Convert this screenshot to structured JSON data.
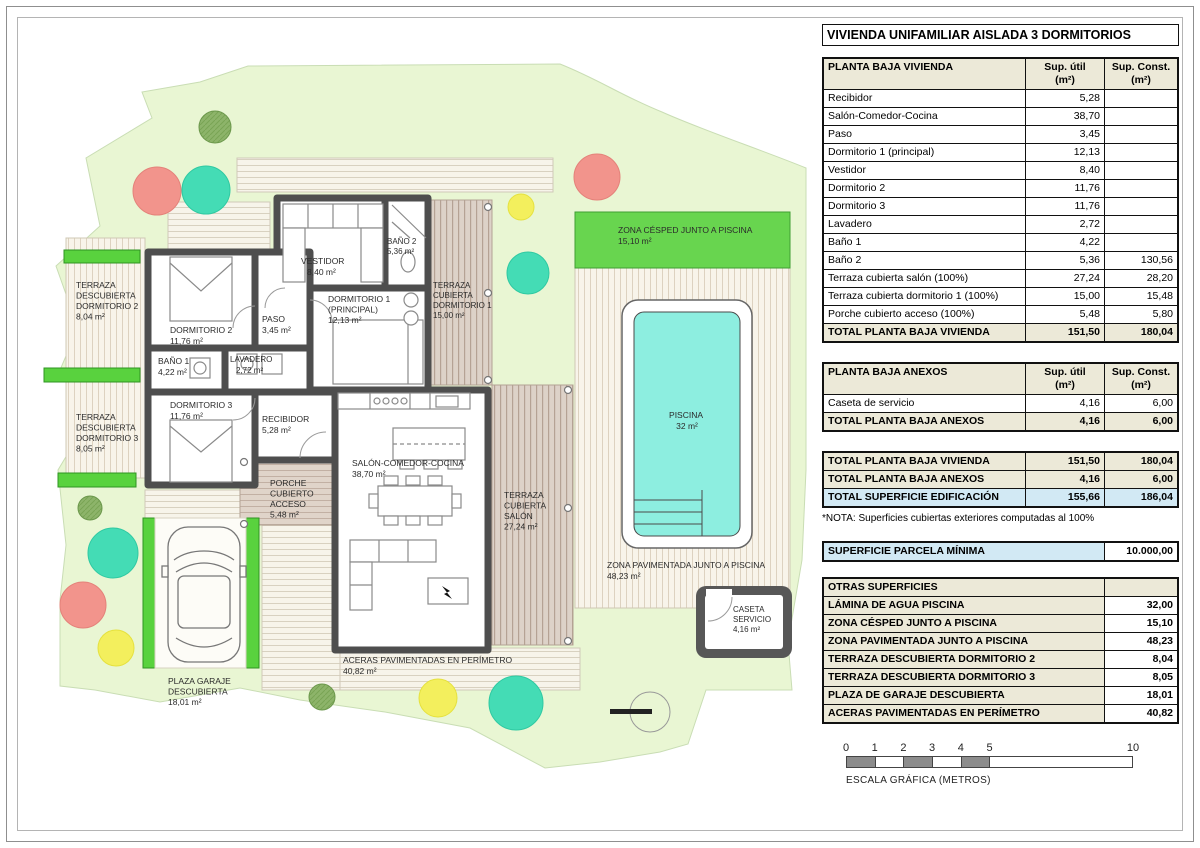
{
  "title": "VIVIENDA UNIFAMILIAR AISLADA 3 DORMITORIOS",
  "columns": {
    "util": "Sup. útil\n(m²)",
    "const": "Sup. Const.\n(m²)"
  },
  "tables": {
    "t1": {
      "header": "PLANTA BAJA VIVIENDA",
      "rows": [
        {
          "l": "Recibidor",
          "u": "5,28",
          "c": ""
        },
        {
          "l": "Salón-Comedor-Cocina",
          "u": "38,70",
          "c": ""
        },
        {
          "l": "Paso",
          "u": "3,45",
          "c": ""
        },
        {
          "l": "Dormitorio 1 (principal)",
          "u": "12,13",
          "c": ""
        },
        {
          "l": "Vestidor",
          "u": "8,40",
          "c": ""
        },
        {
          "l": "Dormitorio 2",
          "u": "11,76",
          "c": ""
        },
        {
          "l": "Dormitorio 3",
          "u": "11,76",
          "c": ""
        },
        {
          "l": "Lavadero",
          "u": "2,72",
          "c": ""
        },
        {
          "l": "Baño 1",
          "u": "4,22",
          "c": ""
        },
        {
          "l": "Baño 2",
          "u": "5,36",
          "c": "130,56"
        },
        {
          "l": "Terraza cubierta salón (100%)",
          "u": "27,24",
          "c": "28,20"
        },
        {
          "l": "Terraza cubierta dormitorio 1 (100%)",
          "u": "15,00",
          "c": "15,48"
        },
        {
          "l": "Porche cubierto acceso (100%)",
          "u": "5,48",
          "c": "5,80"
        }
      ],
      "total": {
        "l": "TOTAL PLANTA BAJA VIVIENDA",
        "u": "151,50",
        "c": "180,04"
      }
    },
    "t2": {
      "header": "PLANTA BAJA ANEXOS",
      "rows": [
        {
          "l": "Caseta de servicio",
          "u": "4,16",
          "c": "6,00"
        }
      ],
      "total": {
        "l": "TOTAL PLANTA BAJA ANEXOS",
        "u": "4,16",
        "c": "6,00"
      }
    },
    "t3": {
      "rows": [
        {
          "l": "TOTAL PLANTA BAJA VIVIENDA",
          "u": "151,50",
          "c": "180,04"
        },
        {
          "l": "TOTAL PLANTA BAJA ANEXOS",
          "u": "4,16",
          "c": "6,00"
        }
      ],
      "total": {
        "l": "TOTAL SUPERFICIE EDIFICACIÓN",
        "u": "155,66",
        "c": "186,04"
      },
      "nota": "*NOTA: Superficies cubiertas exteriores computadas al 100%"
    },
    "t4": {
      "l": "SUPERFICIE PARCELA MÍNIMA",
      "v": "10.000,00"
    },
    "t5": {
      "header": "OTRAS SUPERFICIES",
      "rows": [
        {
          "l": "LÁMINA DE AGUA PISCINA",
          "v": "32,00"
        },
        {
          "l": "ZONA CÉSPED JUNTO A PISCINA",
          "v": "15,10"
        },
        {
          "l": "ZONA PAVIMENTADA JUNTO A PISCINA",
          "v": "48,23"
        },
        {
          "l": "TERRAZA DESCUBIERTA DORMITORIO 2",
          "v": "8,04"
        },
        {
          "l": "TERRAZA DESCUBIERTA DORMITORIO 3",
          "v": "8,05"
        },
        {
          "l": "PLAZA DE GARAJE DESCUBIERTA",
          "v": "18,01"
        },
        {
          "l": "ACERAS PAVIMENTADAS EN PERÍMETRO",
          "v": "40,82"
        }
      ]
    }
  },
  "scale": {
    "ticks": [
      "0",
      "1",
      "2",
      "3",
      "4",
      "5",
      "10"
    ],
    "label": "ESCALA GRÁFICA (METROS)"
  },
  "plan": {
    "labels": {
      "terraza_desc_dorm2": {
        "lines": [
          "TERRAZA",
          "DESCUBIERTA",
          "DORMITORIO 2",
          "8,04 m²"
        ]
      },
      "terraza_desc_dorm3": {
        "lines": [
          "TERRAZA",
          "DESCUBIERTA",
          "DORMITORIO 3",
          "8,05 m²"
        ]
      },
      "dorm2": {
        "lines": [
          "DORMITORIO 2",
          "11,76 m²"
        ]
      },
      "dorm3": {
        "lines": [
          "DORMITORIO 3",
          "11,76 m²"
        ]
      },
      "bano1": {
        "lines": [
          "BAÑO 1",
          "4,22 m²"
        ]
      },
      "lavadero": {
        "lines": [
          "LAVADERO",
          "2,72 m²"
        ]
      },
      "paso": {
        "lines": [
          "PASO",
          "3,45 m²"
        ]
      },
      "vestidor": {
        "lines": [
          "VESTIDOR",
          "8,40 m²"
        ]
      },
      "bano2": {
        "lines": [
          "BAÑO 2",
          "5,36 m²"
        ]
      },
      "dorm1": {
        "lines": [
          "DORMITORIO 1",
          "(PRINCIPAL)",
          "12,13 m²"
        ]
      },
      "terraza_cub_dorm1": {
        "lines": [
          "TERRAZA",
          "CUBIERTA",
          "DORMITORIO 1",
          "15,00 m²"
        ]
      },
      "recibidor": {
        "lines": [
          "RECIBIDOR",
          "5,28 m²"
        ]
      },
      "salon": {
        "lines": [
          "SALÓN-COMEDOR-COCINA",
          "38,70 m²"
        ]
      },
      "terraza_cub_salon": {
        "lines": [
          "TERRAZA",
          "CUBIERTA",
          "SALÓN",
          "27,24 m²"
        ]
      },
      "porche": {
        "lines": [
          "PORCHE",
          "CUBIERTO",
          "ACCESO",
          "5,48 m²"
        ]
      },
      "cesped": {
        "lines": [
          "ZONA CÉSPED JUNTO A PISCINA",
          "15,10 m²"
        ]
      },
      "piscina": {
        "lines": [
          "PISCINA",
          "32 m²"
        ]
      },
      "zona_pav": {
        "lines": [
          "ZONA PAVIMENTADA JUNTO A PISCINA",
          "48,23 m²"
        ]
      },
      "caseta": {
        "lines": [
          "CASETA",
          "SERVICIO",
          "4,16 m²"
        ]
      },
      "garaje": {
        "lines": [
          "PLAZA GARAJE",
          "DESCUBIERTA",
          "18,01 m²"
        ]
      },
      "aceras": {
        "lines": [
          "ACERAS PAVIMENTADAS EN PERÍMETRO",
          "40,82 m²"
        ]
      }
    }
  }
}
